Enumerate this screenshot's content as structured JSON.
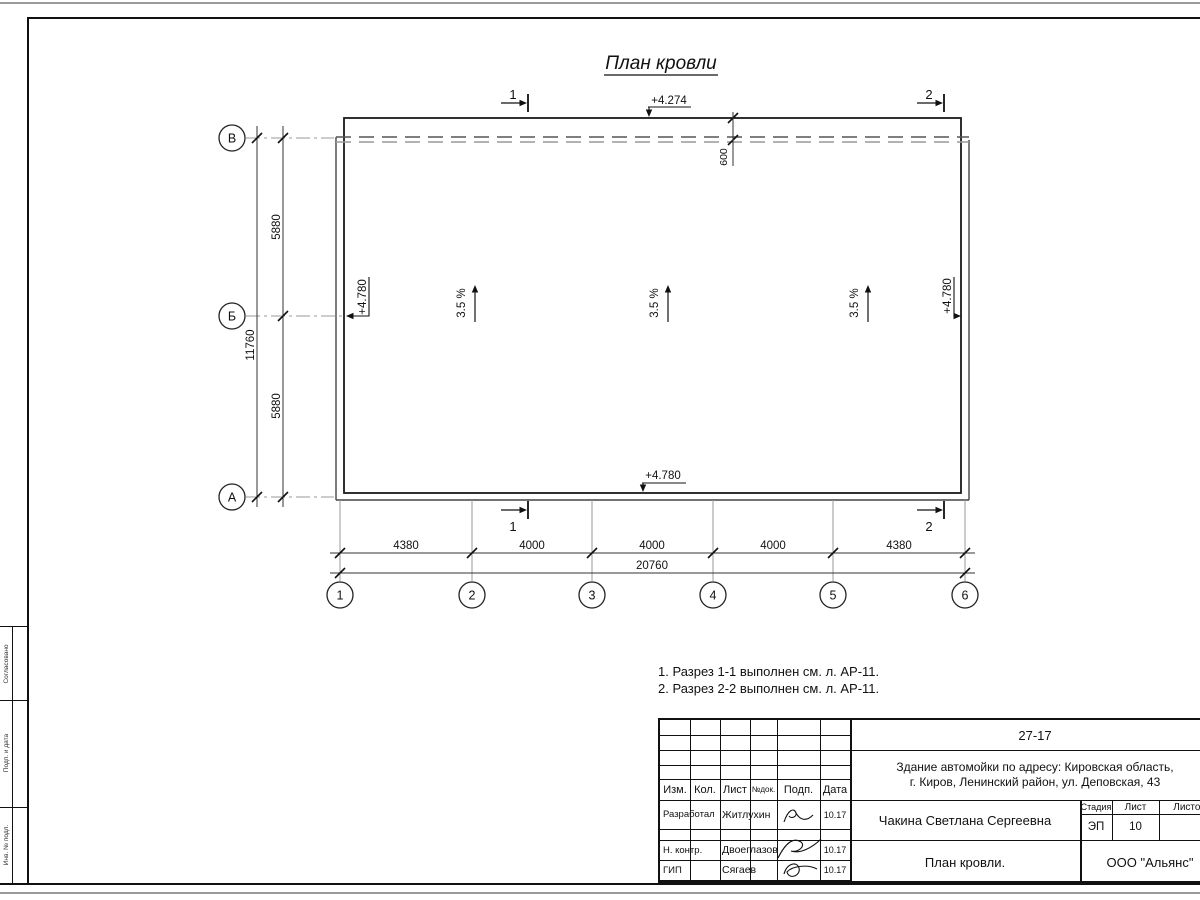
{
  "title": "План кровли",
  "plan": {
    "elev_top": "+4.274",
    "elev_roof": "+4.780",
    "overhang": "600",
    "slope": "3.5 %",
    "section1": "1",
    "section2": "2"
  },
  "axes": {
    "rows": [
      "В",
      "Б",
      "А"
    ],
    "cols": [
      "1",
      "2",
      "3",
      "4",
      "5",
      "6"
    ]
  },
  "dims": {
    "left_total": "11760",
    "left_segs": [
      "5880",
      "5880"
    ],
    "bottom_segs": [
      "4380",
      "4000",
      "4000",
      "4000",
      "4380"
    ],
    "bottom_total": "20760"
  },
  "notes": [
    "1. Разрез 1-1 выполнен см. л. АР-11.",
    "2. Разрез 2-2 выполнен см. л. АР-11."
  ],
  "stamp": {
    "doc_code": "27-17",
    "project_line1": "Здание автомойки по адресу: Кировская область,",
    "project_line2": "г. Киров, Ленинский район, ул. Деповская, 43",
    "author": "Чакина Светлана Сергеевна",
    "drawing_name": "План кровли.",
    "org": "ООО \"Альянс\"",
    "stage_label": "Стадия",
    "list_label": "Лист",
    "listov_label": "Листов",
    "stage": "ЭП",
    "sheet_no": "10",
    "cols": [
      "Изм.",
      "Кол.",
      "Лист",
      "№док.",
      "Подп.",
      "Дата"
    ],
    "roles": [
      {
        "r": "Разработал",
        "n": "Житлухин",
        "d": "10.17"
      },
      {
        "r": "Н. контр.",
        "n": "Двоеглазов",
        "d": "10.17"
      },
      {
        "r": "ГИП",
        "n": "Сягаев",
        "d": "10.17"
      }
    ],
    "side_labels": [
      "Согласовано",
      "Подп. и дата",
      "Инв. № подл."
    ]
  }
}
